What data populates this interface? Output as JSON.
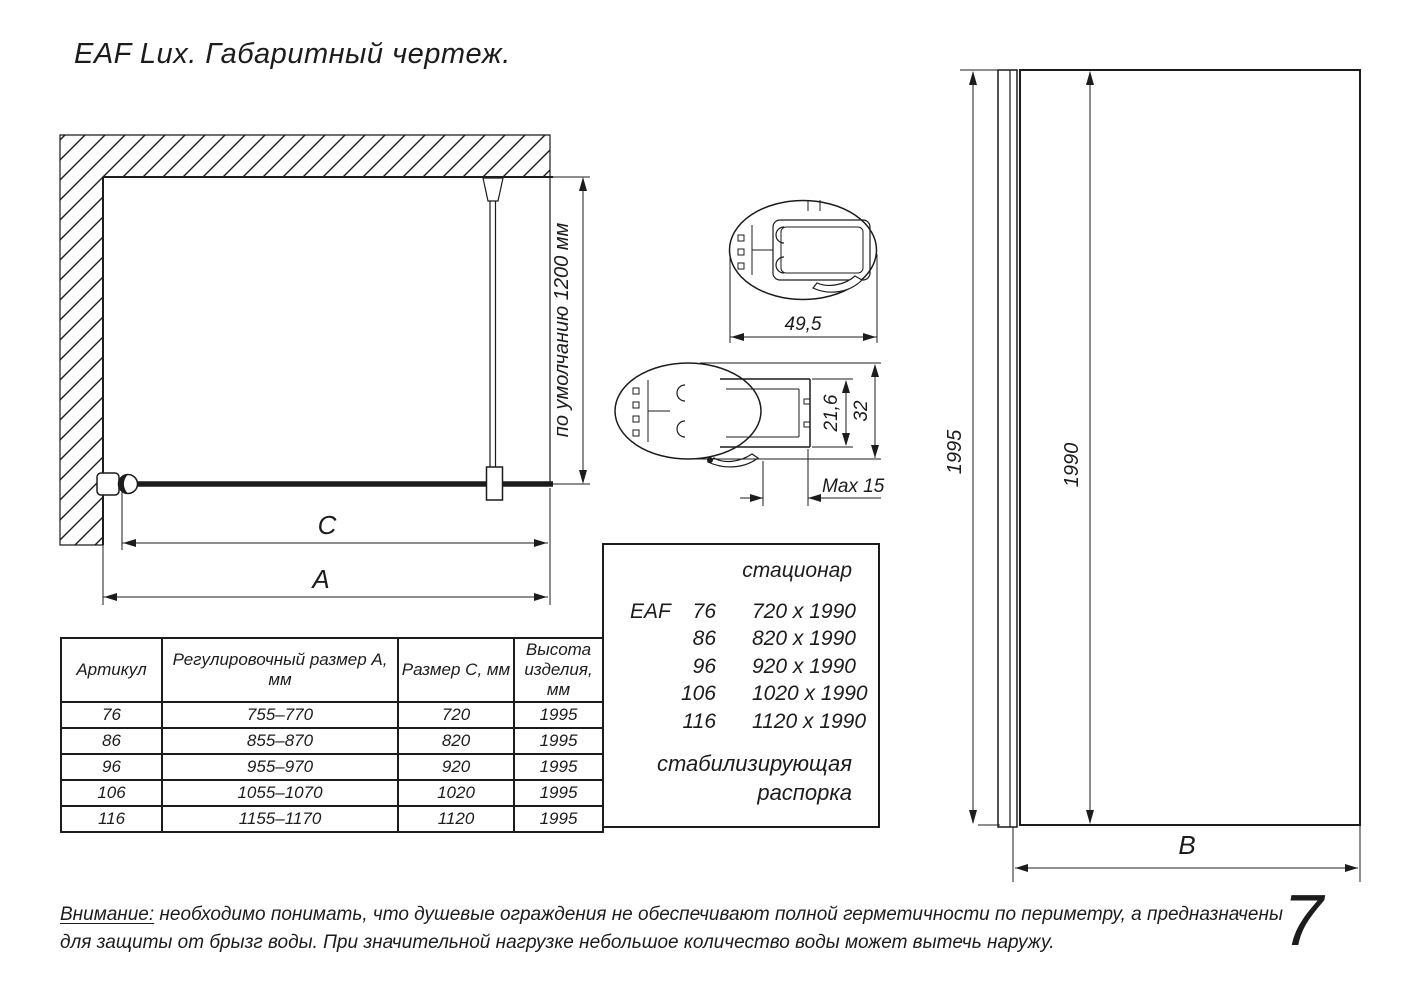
{
  "title": "EAF Lux. Габаритный чертеж.",
  "page_number": "7",
  "colors": {
    "ink": "#1c1c1c",
    "background": "#ffffff"
  },
  "plan_view": {
    "bar_length_label": "по умолчанию 1200 мм",
    "dim_c": "C",
    "dim_a": "A"
  },
  "profiles": {
    "width": "49,5",
    "inner_height": "21,6",
    "outer_height": "32",
    "max_adjust": "Max 15"
  },
  "side_view": {
    "total_height": "1995",
    "glass_height": "1990",
    "dim_b": "B"
  },
  "table": {
    "headers": [
      "Артикул",
      "Регулировочный размер А, мм",
      "Размер С, мм",
      "Высота изделия, мм"
    ],
    "rows": [
      [
        "76",
        "755–770",
        "720",
        "1995"
      ],
      [
        "86",
        "855–870",
        "820",
        "1995"
      ],
      [
        "96",
        "955–970",
        "920",
        "1995"
      ],
      [
        "106",
        "1055–1070",
        "1020",
        "1995"
      ],
      [
        "116",
        "1155–1170",
        "1120",
        "1995"
      ]
    ]
  },
  "spec_box": {
    "header": "стационар",
    "series": "EAF",
    "rows": [
      {
        "size": "76",
        "dims": "720 x 1990"
      },
      {
        "size": "86",
        "dims": "820 x 1990"
      },
      {
        "size": "96",
        "dims": "920 x 1990"
      },
      {
        "size": "106",
        "dims": "1020 x 1990"
      },
      {
        "size": "116",
        "dims": "1120 x 1990"
      }
    ],
    "footer_line1": "стабилизирующая",
    "footer_line2": "распорка"
  },
  "note": {
    "label": "Внимание:",
    "line1": " необходимо понимать, что душевые ограждения не обеспечивают полной герметичности по периметру, а предназначены",
    "line2": "для защиты от брызг воды. При значительной нагрузке небольшое количество воды может вытечь наружу."
  }
}
